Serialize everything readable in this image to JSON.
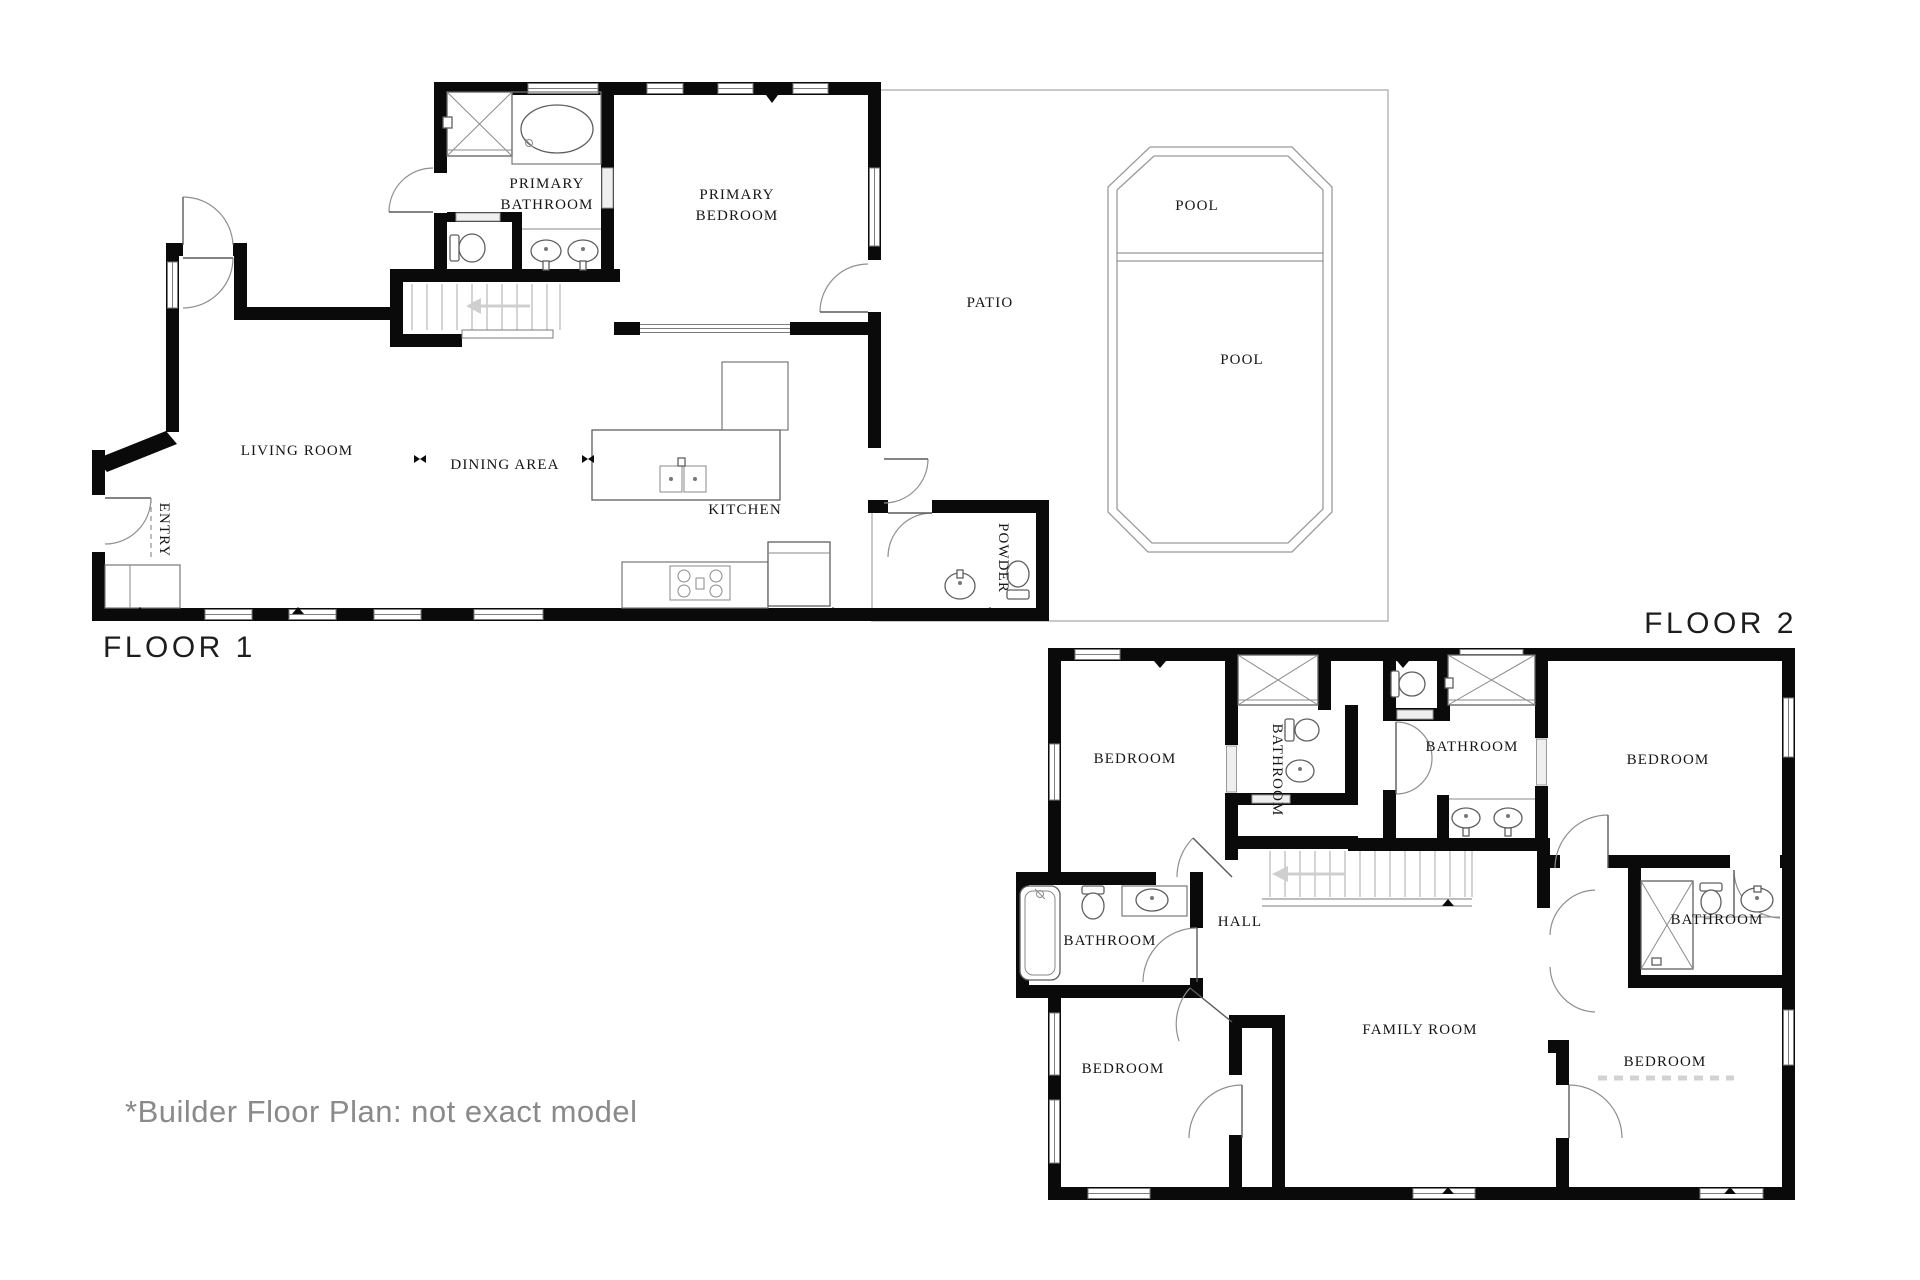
{
  "page": {
    "background": "#ffffff",
    "wall_color": "#0a0a0a",
    "note": "*Builder Floor Plan: not exact model",
    "note_color": "#8a8a8a"
  },
  "floor1": {
    "title": "FLOOR 1",
    "rooms": {
      "primary_bathroom": {
        "line1": "PRIMARY",
        "line2": "BATHROOM"
      },
      "primary_bedroom": {
        "line1": "PRIMARY",
        "line2": "BEDROOM"
      },
      "patio": "PATIO",
      "pool_upper": "POOL",
      "pool_main": "POOL",
      "living_room": "LIVING ROOM",
      "dining_area": "DINING AREA",
      "kitchen": "KITCHEN",
      "entry": "ENTRY",
      "powder": "POWDER"
    }
  },
  "floor2": {
    "title": "FLOOR 2",
    "rooms": {
      "bedroom_top_left": "BEDROOM",
      "bathroom_top_left": "BATHROOM",
      "bathroom_middle": "BATHROOM",
      "bedroom_top_right": "BEDROOM",
      "hall": "HALL",
      "bathroom_left": "BATHROOM",
      "bedroom_bottom_left": "BEDROOM",
      "family_room": "FAMILY ROOM",
      "bathroom_right": "BATHROOM",
      "bedroom_bottom_right": "BEDROOM"
    }
  }
}
